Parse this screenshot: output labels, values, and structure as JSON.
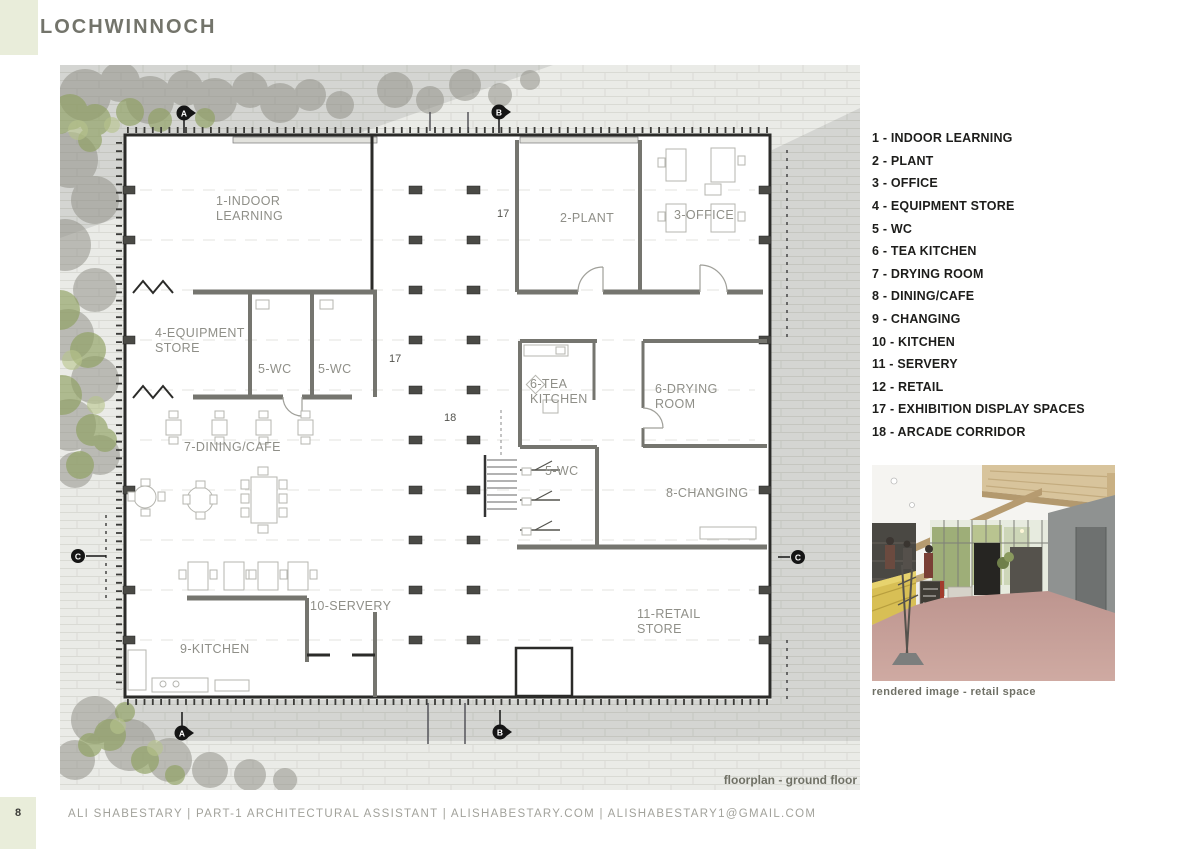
{
  "page": {
    "title": "LOCHWINNOCH",
    "page_number": "8",
    "footer": "ALI SHABESTARY  |  PART-1 ARCHITECTURAL ASSISTANT  |  ALISHABESTARY.COM  |  ALISHABESTARY1@GMAIL.COM"
  },
  "colors": {
    "accent_green": "#e9edda",
    "site_gray": "#eaebe7",
    "wall_black": "#2b2b29",
    "label_gray": "#8f8f88",
    "caption_gray": "#6f7066"
  },
  "legend": {
    "items": [
      "1 - INDOOR LEARNING",
      "2 - PLANT",
      "3 - OFFICE",
      "4 - EQUIPMENT STORE",
      "5 - WC",
      "6 - TEA KITCHEN",
      "7 - DRYING ROOM",
      "8 - DINING/CAFE",
      "9 - CHANGING",
      "10 - KITCHEN",
      "11 - SERVERY",
      "12 - RETAIL",
      "17 - EXHIBITION DISPLAY SPACES",
      "18 - ARCADE CORRIDOR"
    ]
  },
  "plan": {
    "caption": "floorplan - ground floor",
    "labels": [
      {
        "l1": "1-INDOOR",
        "l2": "LEARNING"
      },
      {
        "l1": "2-PLANT",
        "l2": ""
      },
      {
        "l1": "3-OFFICE",
        "l2": ""
      },
      {
        "l1": "4-EQUIPMENT",
        "l2": "STORE"
      },
      {
        "l1": "5-WC",
        "l2": ""
      },
      {
        "l1": "5-WC",
        "l2": ""
      },
      {
        "l1": "6-TEA",
        "l2": "KITCHEN"
      },
      {
        "l1": "6-DRYING",
        "l2": "ROOM"
      },
      {
        "l1": "5-WC",
        "l2": ""
      },
      {
        "l1": "7-DINING/CAFE",
        "l2": ""
      },
      {
        "l1": "8-CHANGING",
        "l2": ""
      },
      {
        "l1": "10-SERVERY",
        "l2": ""
      },
      {
        "l1": "9-KITCHEN",
        "l2": ""
      },
      {
        "l1": "11-RETAIL",
        "l2": "STORE"
      }
    ],
    "zone_numbers": [
      "17",
      "17",
      "18"
    ],
    "section_markers": [
      "A",
      "B",
      "A",
      "B",
      "C",
      "C"
    ]
  },
  "photo": {
    "caption": "rendered image - retail space"
  }
}
